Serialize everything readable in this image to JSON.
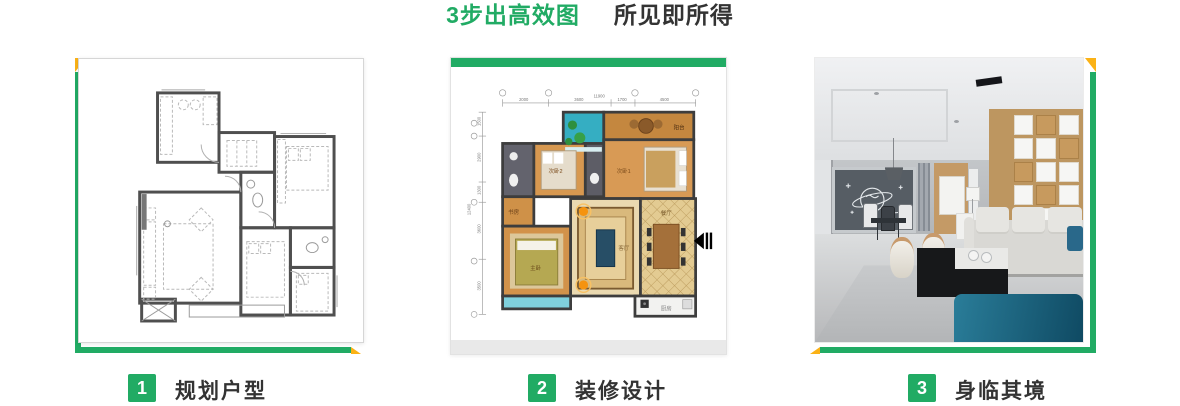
{
  "title": {
    "highlight": "3步出高效图",
    "rest": "所见即所得"
  },
  "steps": [
    {
      "num": "1",
      "label": "规划户型"
    },
    {
      "num": "2",
      "label": "装修设计"
    },
    {
      "num": "3",
      "label": "身临其境"
    }
  ],
  "floorplan": {
    "dims_top": [
      "2000",
      "3600",
      "1700",
      "4500"
    ],
    "dims_top_total": "11900",
    "dims_left": [
      "1500",
      "2900",
      "1300",
      "3600",
      "3500"
    ],
    "dims_left_total": "12400",
    "rooms": {
      "balcony": "阳台",
      "bedroom1": "次卧1",
      "bedroom2": "次卧2",
      "study": "书房",
      "master": "主卧",
      "living": "客厅",
      "dining": "餐厅",
      "kitchen": "厨房"
    }
  },
  "colors": {
    "green": "#21ab64",
    "yellow": "#fbb216",
    "text_dark": "#333333"
  }
}
